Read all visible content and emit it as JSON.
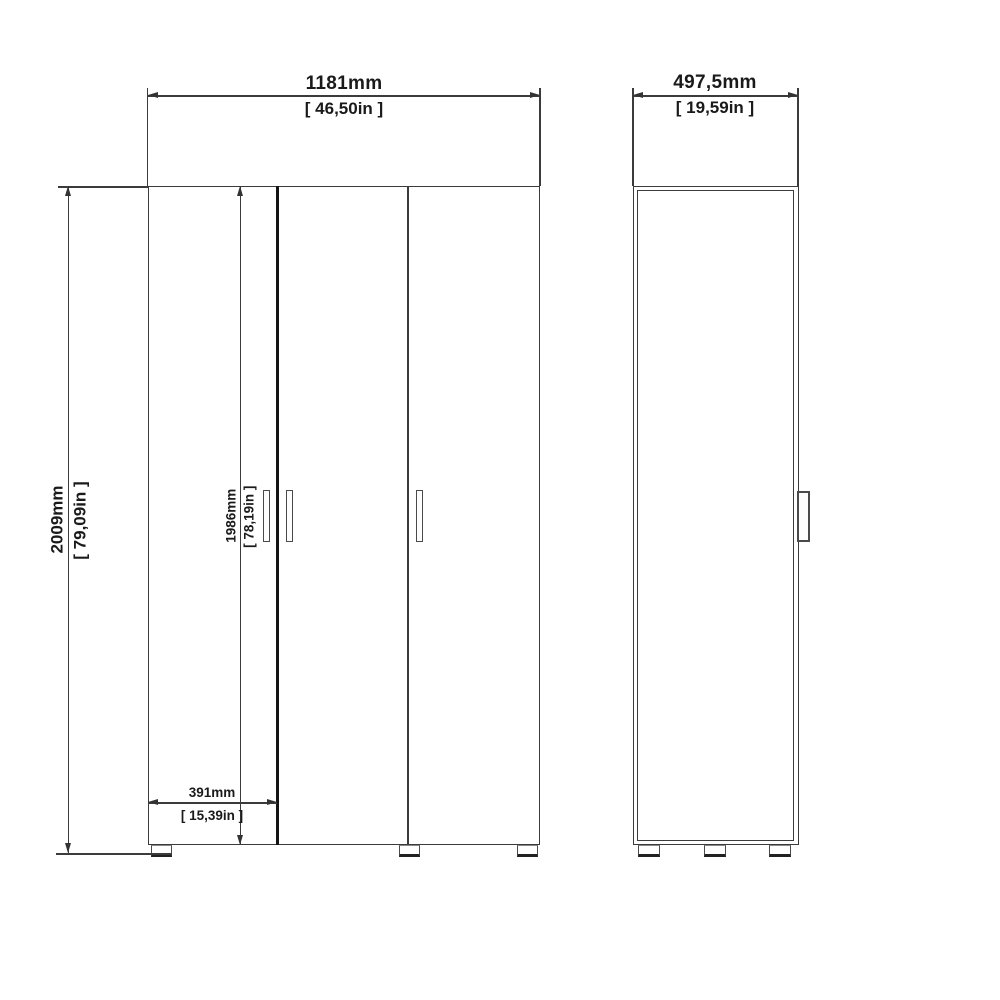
{
  "drawing": {
    "type": "furniture-technical-drawing",
    "subject": "three-door wardrobe, front and side elevation with dimensions",
    "front_view": {
      "overall_width": {
        "mm": "1181mm",
        "in": "[ 46,50in ]"
      },
      "overall_height": {
        "mm": "2009mm",
        "in": "[ 79,09in ]"
      },
      "door_height": {
        "mm": "1986mm",
        "in": "[ 78,19in ]"
      },
      "door_width": {
        "mm": "391mm",
        "in": "[ 15,39in ]"
      }
    },
    "side_view": {
      "overall_depth": {
        "mm": "497,5mm",
        "in": "[ 19,59in ]"
      }
    },
    "colors": {
      "background": "#ffffff",
      "line": "#3b3b3b",
      "thick_line": "#141414",
      "text": "#1a1a1a"
    }
  }
}
